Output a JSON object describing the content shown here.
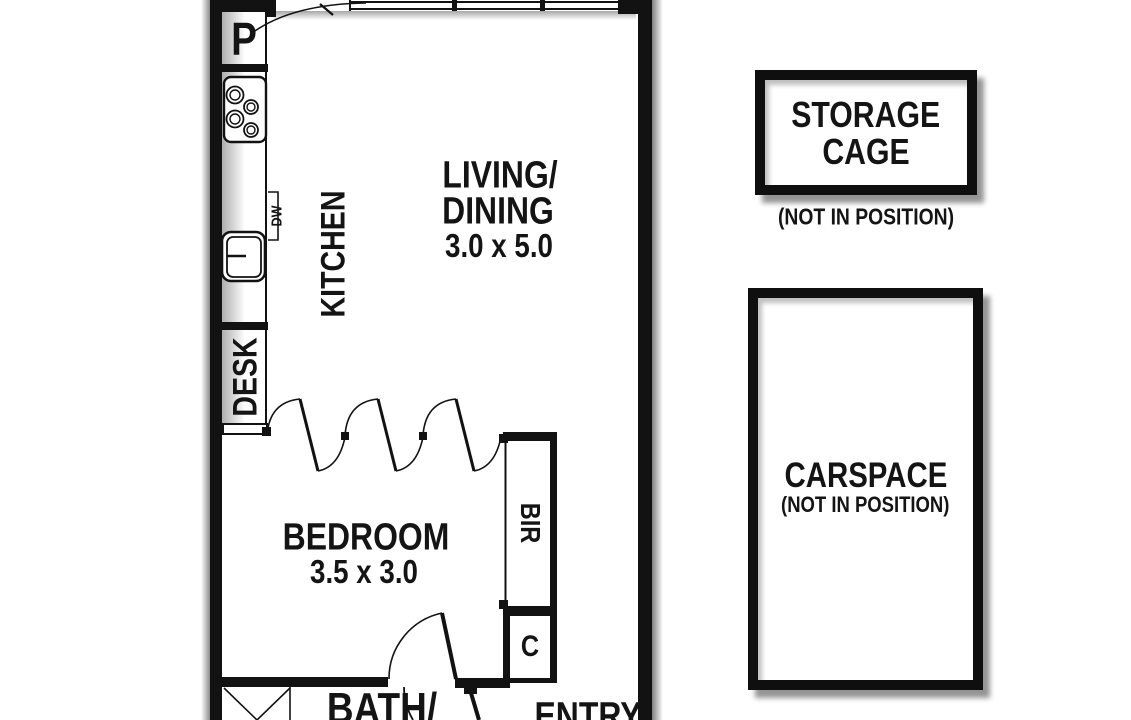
{
  "title": "Apartment floor plan",
  "unit_labels": {
    "pantry": "P",
    "dishwasher": "DW",
    "kitchen": "KITCHEN",
    "desk": "DESK",
    "living_line1": "LIVING/",
    "living_line2": "DINING",
    "living_dims": "3.0 x 5.0",
    "bedroom": "BEDROOM",
    "bedroom_dims": "3.5 x 3.0",
    "robe": "BIR",
    "cupboard": "C",
    "bath": "BATH/",
    "entry": "ENTRY"
  },
  "annex": {
    "storage_line1": "STORAGE",
    "storage_line2": "CAGE",
    "storage_note": "(NOT IN POSITION)",
    "carspace_label": "CARSPACE",
    "carspace_note": "(NOT IN POSITION)"
  },
  "icons": {
    "stove": "stove-icon",
    "sink": "sink-icon",
    "shower": "shower-icon",
    "window": "window-icon",
    "bifold_doors": "bifold-door-icon",
    "bedroom_door": "door-swing-icon",
    "entry_door": "door-swing-icon"
  },
  "colors": {
    "wall": "#121212",
    "background": "#ffffff",
    "shadow": "#999999"
  }
}
